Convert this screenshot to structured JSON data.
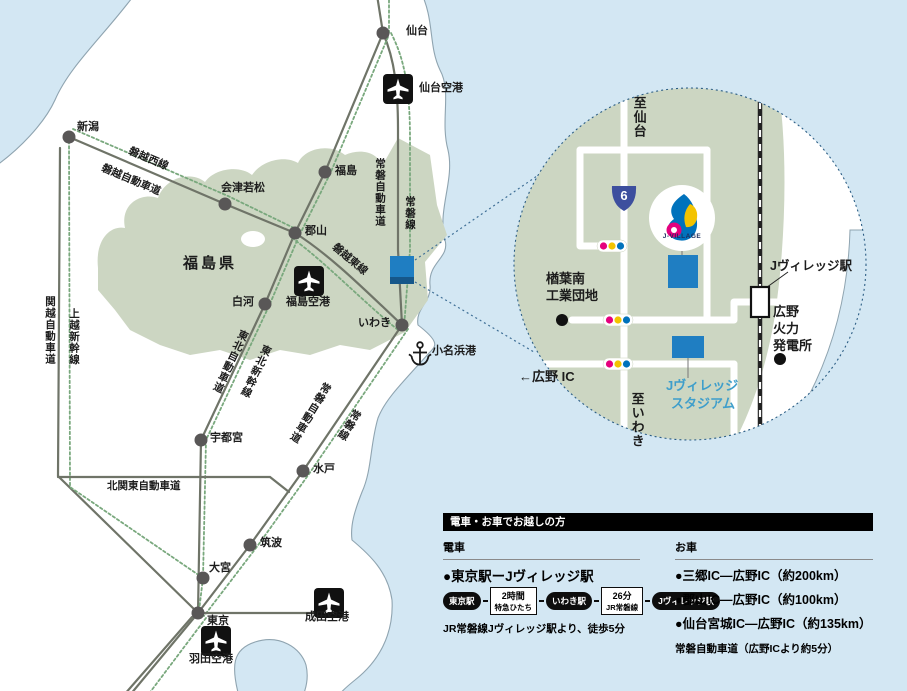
{
  "colors": {
    "sea": "#d3e7f3",
    "land": "#ffffff",
    "coast": "#8fa4b0",
    "prefecture_green": "#ccd6c2",
    "road_gray": "#6f7468",
    "rail_green": "#79a87d",
    "node_gray": "#595757",
    "jvillage_blue": "#1f7ec2",
    "stadium_text_blue": "#3e9ecb",
    "route_shield_blue": "#3d4f9e",
    "signal_pink": "#e5007e",
    "signal_yellow": "#f3c300",
    "signal_blue": "#0072bc"
  },
  "main_map": {
    "region": "福島県",
    "cities": {
      "sendai": "仙台",
      "niigata": "新潟",
      "aizu": "会津若松",
      "fukushima": "福島",
      "koriyama": "郡山",
      "shirakawa": "白河",
      "iwaki": "いわき",
      "utsunomiya": "宇都宮",
      "mito": "水戸",
      "tsukuba": "筑波",
      "omiya": "大宮",
      "tokyo": "東京"
    },
    "airports": {
      "sendai": "仙台空港",
      "fukushima": "福島空港",
      "narita": "成田空港",
      "haneda": "羽田空港"
    },
    "port": "小名浜港",
    "routes": {
      "banetsu_west_line": "磐越西線",
      "banetsu_expwy": "磐越自動車道",
      "joban_expwy_north": "常磐自動車道",
      "joban_line_north": "常磐線",
      "kanetsu_expwy": "関越自動車道",
      "joetsu_shinkansen": "上越新幹線",
      "tohoku_expwy": "東北自動車道",
      "tohoku_shinkansen": "東北新幹線",
      "banetsu_east_line": "磐越東線",
      "joban_expwy_south": "常磐自動車道",
      "joban_line_south": "常磐線",
      "kitakanto_expwy": "北関東自動車道"
    }
  },
  "inset": {
    "to_sendai": "至仙台",
    "to_iwaki": "至いわき",
    "route_number": "6",
    "logo": "J-VILLAGE",
    "industrial_park_line1": "楢葉南",
    "industrial_park_line2": "工業団地",
    "station": "Jヴィレッジ駅",
    "power_plant_line1": "広野",
    "power_plant_line2": "火力",
    "power_plant_line3": "発電所",
    "hirono_ic": "←広野 IC",
    "stadium_line1": "Jヴィレッジ",
    "stadium_line2": "スタジアム"
  },
  "info_panel": {
    "header": "電車・お車でお越しの方",
    "train_section": {
      "title": "電車",
      "route_title": "●東京駅ーJヴィレッジ駅",
      "steps": [
        {
          "label": "東京駅"
        },
        {
          "line1": "2時間",
          "line2": "特急ひたち"
        },
        {
          "label": "いわき駅"
        },
        {
          "line1": "26分",
          "line2": "JR常磐線"
        },
        {
          "label": "Jヴィレッジ駅"
        }
      ],
      "note": "JR常磐線Jヴィレッジ駅より、徒歩5分"
    },
    "car_section": {
      "title": "お車",
      "routes": [
        "●三郷IC―広野IC（約200km）",
        "●郡山IC―広野IC（約100km）",
        "●仙台宮城IC―広野IC（約135km）"
      ],
      "note": "常磐自動車道（広野ICより約5分）"
    }
  }
}
